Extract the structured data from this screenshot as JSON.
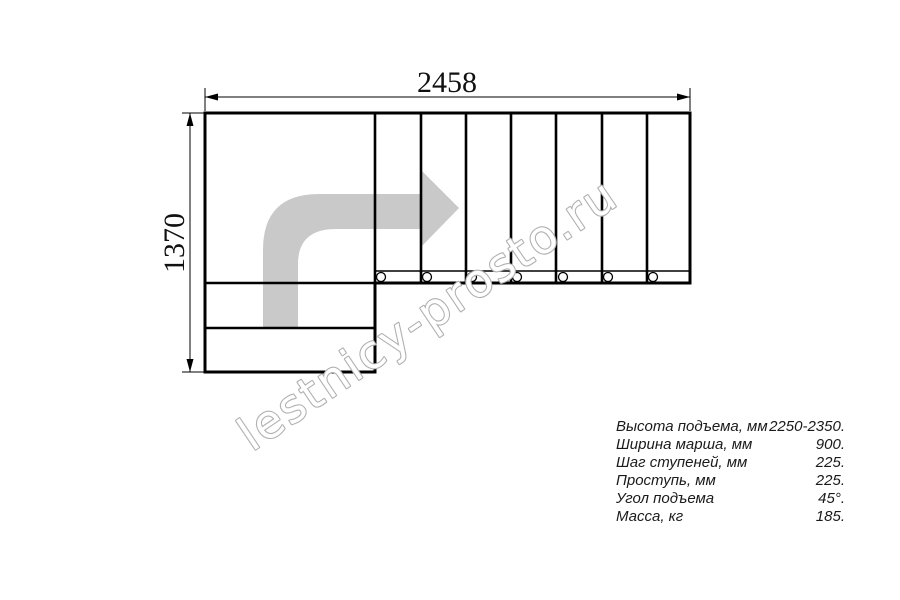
{
  "drawing": {
    "dimension_width": "2458",
    "dimension_height": "1370",
    "watermark": "lestnicy-prosto.ru",
    "colors": {
      "line": "#000000",
      "arrow_fill": "#c9c9c9",
      "watermark_stroke": "#b0b0b0",
      "background": "#ffffff"
    }
  },
  "specs": {
    "rows": [
      {
        "label": "Высота подъема, мм",
        "value": "2250-2350."
      },
      {
        "label": "Ширина марша, мм",
        "value": "900."
      },
      {
        "label": "Шаг ступеней, мм",
        "value": "225."
      },
      {
        "label": "Проступь, мм",
        "value": "225."
      },
      {
        "label": "Угол подъема",
        "value": "45°."
      },
      {
        "label": "Масса, кг",
        "value": "185."
      }
    ]
  }
}
